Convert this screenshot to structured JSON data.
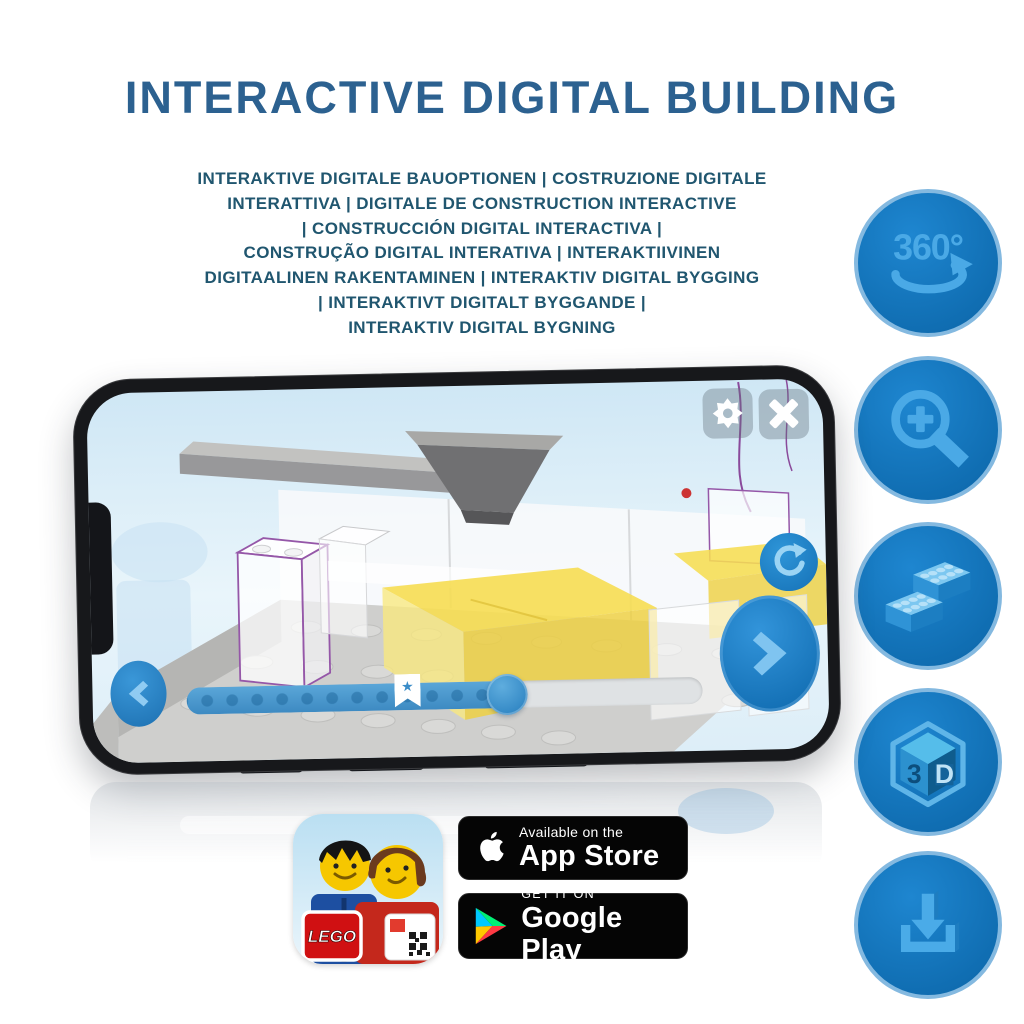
{
  "title": "INTERACTIVE DIGITAL BUILDING",
  "subtitle": {
    "lines": [
      "INTERAKTIVE DIGITALE BAUOPTIONEN | COSTRUZIONE DIGITALE",
      "INTERATTIVA | DIGITALE DE CONSTRUCTION INTERACTIVE",
      "| CONSTRUCCIÓN DIGITAL INTERACTIVA |",
      "CONSTRUÇÃO DIGITAL INTERATIVA | INTERAKTIIVINEN",
      "DIGITAALINEN RAKENTAMINEN | INTERAKTIV DIGITAL BYGGING",
      "| INTERAKTIVT DIGITALT BYGGANDE |",
      "INTERAKTIV DIGITAL BYGNING"
    ]
  },
  "feature_icons": {
    "items": [
      {
        "name": "360-rotation",
        "label": "360°"
      },
      {
        "name": "zoom-in"
      },
      {
        "name": "building-brick"
      },
      {
        "name": "3d-view",
        "cube_left": "3",
        "cube_right": "D"
      },
      {
        "name": "download"
      }
    ]
  },
  "phone_app": {
    "controls": [
      "settings",
      "close",
      "reset-rotation",
      "previous-step",
      "next-step",
      "build-progress-slider"
    ],
    "progress_percent": 62,
    "slider_star_marker": "★"
  },
  "badges": {
    "lego_app": {
      "logo_text": "LEGO"
    },
    "app_store": {
      "tagline": "Available on the",
      "store_name": "App Store"
    },
    "google_play": {
      "tagline": "GET IT ON",
      "store_name": "Google Play"
    }
  },
  "colors": {
    "title_blue": "#2c6190",
    "subtitle_blue": "#20566f",
    "circle_blue": "#1478c4",
    "glyph_blue": "#4aa9e6",
    "screen_sky": "#d2e9f7",
    "brick_yellow": "#f4da4a",
    "outline_purple": "#9557a8"
  }
}
